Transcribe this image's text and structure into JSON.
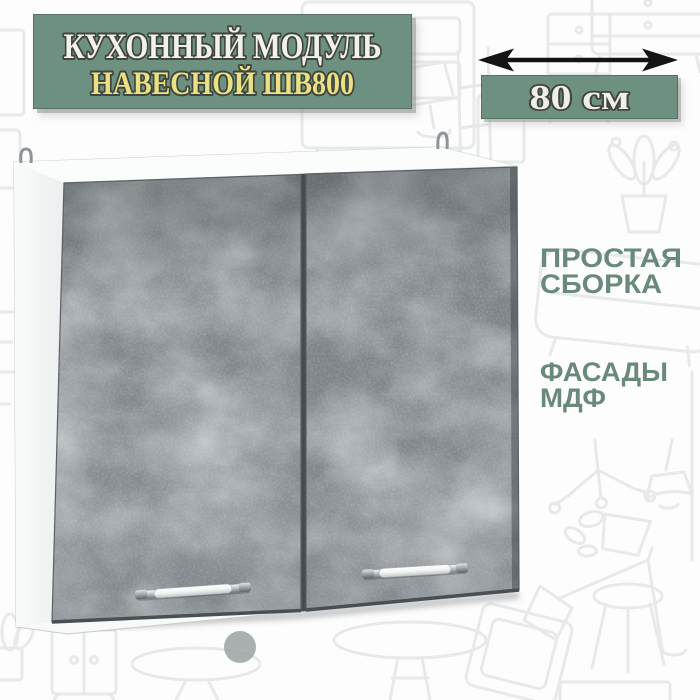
{
  "banner": {
    "line1": "КУХОННЫЙ МОДУЛЬ",
    "line2": "НАВЕСНОЙ ШВ800",
    "bg_color": "#6d9080",
    "line1_color": "#f3f2ea",
    "line2_color": "#e9e183",
    "outline_color": "#41453e"
  },
  "dimension": {
    "label": "80 см",
    "bg_color": "#6d9080",
    "text_color": "#eef0e7",
    "arrow_color": "#141414"
  },
  "features": {
    "color": "#69897b",
    "items": [
      {
        "line1": "ПРОСТАЯ",
        "line2": "СБОРКА"
      },
      {
        "line1": "ФАСАДЫ",
        "line2": "МДФ"
      }
    ]
  },
  "cabinet": {
    "doors": 2,
    "handles": 2,
    "hanger_loops": 2,
    "carcass_color": "#f8f9f9",
    "side_color": "#f2f3f4",
    "door_base_color": "#80868a",
    "door_texture": "concrete",
    "handle_style": "chrome bar"
  },
  "background": {
    "doodle_color": "#e8eaea",
    "style": "furniture sketch outlines"
  }
}
